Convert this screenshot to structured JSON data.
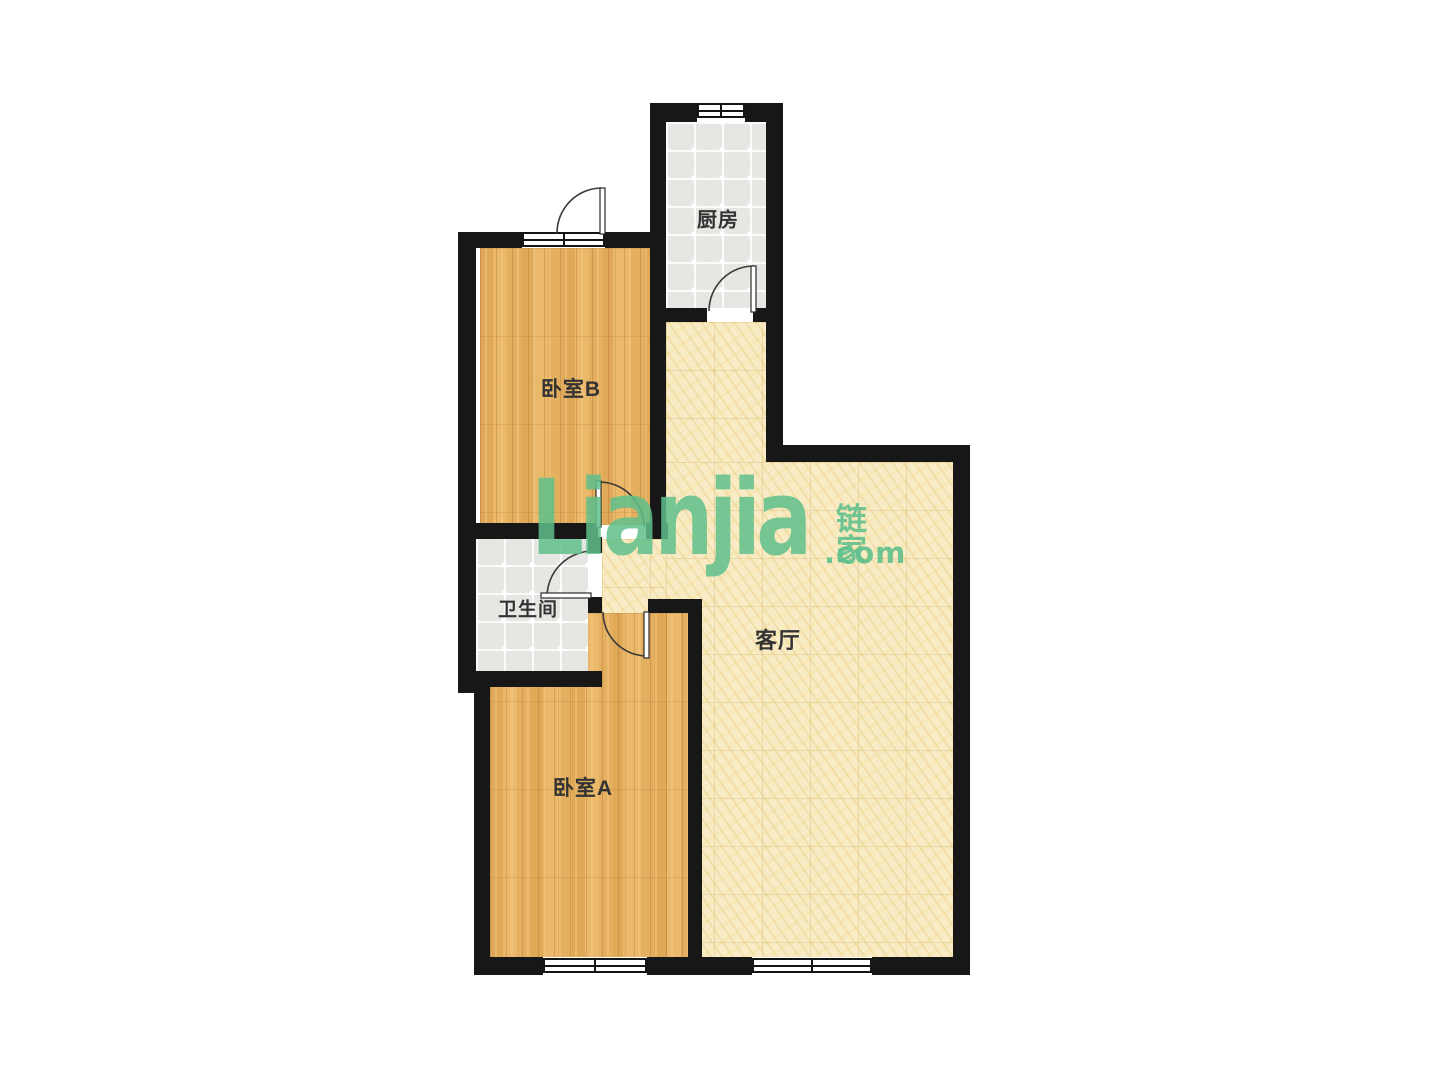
{
  "floorplan": {
    "rooms": {
      "kitchen": {
        "label": "厨房"
      },
      "bedroom_b": {
        "label": "卧室B"
      },
      "bathroom": {
        "label": "卫生间"
      },
      "bedroom_a": {
        "label": "卧室A"
      },
      "living_room": {
        "label": "客厅"
      }
    },
    "watermark": {
      "logo_text": "Lianjia",
      "logo_cn": "链家",
      "logo_domain": ".com",
      "logo_color": "#5fc08c"
    },
    "colors": {
      "wall": "#171717",
      "wood_floor": "#e8b766",
      "gray_tile": "#e6e6e2",
      "cream_tile": "#f8ecc6",
      "label_text": "#333333",
      "door_line": "#3a3a3a"
    }
  }
}
